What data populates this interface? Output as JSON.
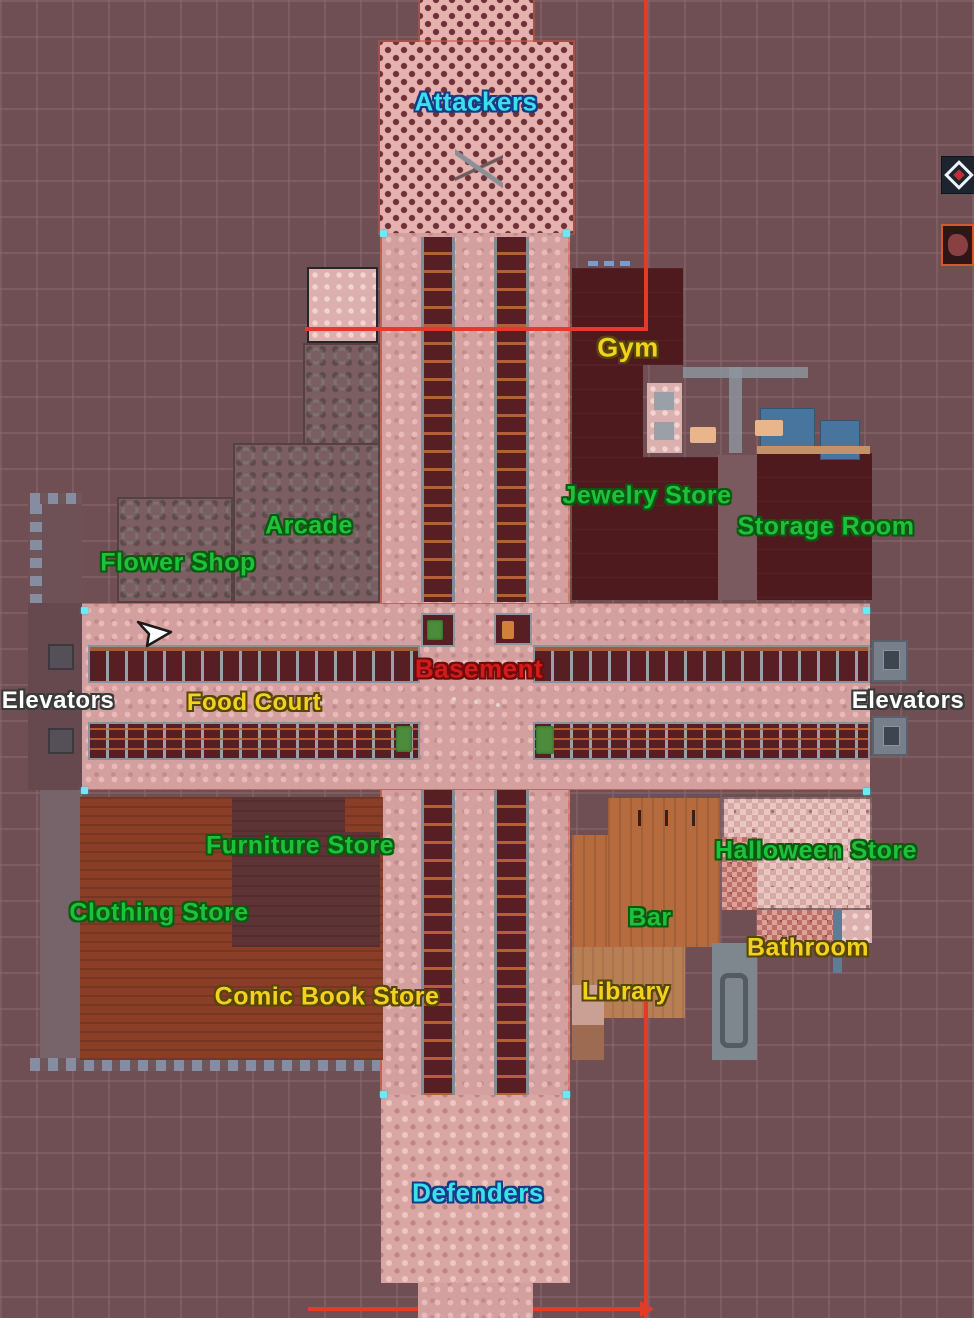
{
  "map": {
    "title": "mall-map-overview",
    "teams": [
      "Attackers",
      "Defenders"
    ],
    "labels": [
      {
        "id": "attackers",
        "text": "Attackers",
        "color": "cyan",
        "x": 476,
        "y": 102,
        "size": 26
      },
      {
        "id": "gym",
        "text": "Gym",
        "color": "yellow",
        "x": 628,
        "y": 348,
        "size": 27
      },
      {
        "id": "jewelry-store",
        "text": "Jewelry Store",
        "color": "green",
        "x": 647,
        "y": 496,
        "size": 25
      },
      {
        "id": "storage-room",
        "text": "Storage Room",
        "color": "green",
        "x": 826,
        "y": 527,
        "size": 25
      },
      {
        "id": "arcade",
        "text": "Arcade",
        "color": "green",
        "x": 309,
        "y": 526,
        "size": 25
      },
      {
        "id": "flower-shop",
        "text": "Flower Shop",
        "color": "green",
        "x": 178,
        "y": 563,
        "size": 25
      },
      {
        "id": "elevators-left",
        "text": "Elevators",
        "color": "white",
        "x": 58,
        "y": 701,
        "size": 24
      },
      {
        "id": "food-court",
        "text": "Food Court",
        "color": "yellow",
        "x": 254,
        "y": 703,
        "size": 24
      },
      {
        "id": "basement",
        "text": "Basement",
        "color": "red",
        "x": 479,
        "y": 669,
        "size": 26
      },
      {
        "id": "elevators-right",
        "text": "Elevators",
        "color": "white",
        "x": 908,
        "y": 701,
        "size": 24
      },
      {
        "id": "furniture-store",
        "text": "Furniture Store",
        "color": "green",
        "x": 300,
        "y": 846,
        "size": 25
      },
      {
        "id": "clothing-store",
        "text": "Clothing Store",
        "color": "green",
        "x": 159,
        "y": 913,
        "size": 25
      },
      {
        "id": "comic-book-store",
        "text": "Comic Book Store",
        "color": "yellow",
        "x": 327,
        "y": 997,
        "size": 25
      },
      {
        "id": "halloween-store",
        "text": "Halloween Store",
        "color": "green",
        "x": 816,
        "y": 851,
        "size": 25
      },
      {
        "id": "bar",
        "text": "Bar",
        "color": "green",
        "x": 650,
        "y": 918,
        "size": 25
      },
      {
        "id": "bathroom",
        "text": "Bathroom",
        "color": "yellow",
        "x": 808,
        "y": 948,
        "size": 25
      },
      {
        "id": "library",
        "text": "Library",
        "color": "yellow",
        "x": 626,
        "y": 992,
        "size": 25
      },
      {
        "id": "defenders",
        "text": "Defenders",
        "color": "cyan",
        "x": 478,
        "y": 1193,
        "size": 26
      }
    ],
    "label_colors": {
      "green": {
        "fill": "#1ec23a",
        "outline": "#0b5a12"
      },
      "yellow": {
        "fill": "#f4d11f",
        "outline": "#564709"
      },
      "cyan": {
        "fill": "#3ae0ea",
        "outline": "#173a86"
      },
      "white": {
        "fill": "#ffffff",
        "outline": "#3a3a3a"
      },
      "red": {
        "fill": "#d41b1b",
        "outline": "#6e0c0c"
      }
    },
    "boundary_color": "#e23c28",
    "cursor": {
      "x": 135,
      "y": 619
    }
  }
}
